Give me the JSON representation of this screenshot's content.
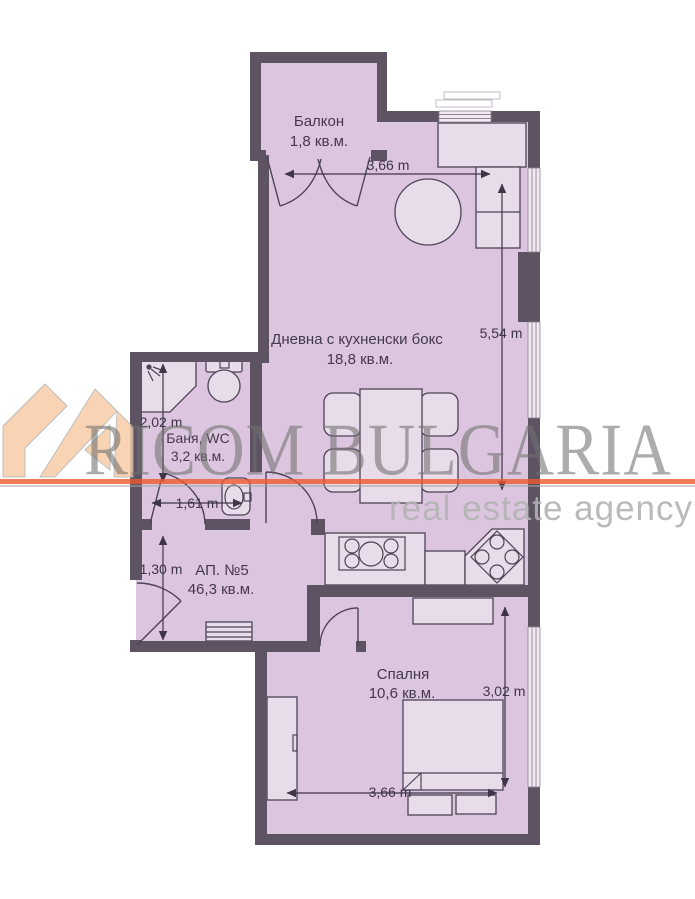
{
  "watermark": {
    "brand": "RICOM BULGARIA",
    "tagline": "real estate agency",
    "accent_color": "#ee5a2d",
    "logo_color": "#f8cda8",
    "brand_text_color": "#707070",
    "tagline_color": "#b2b2b2"
  },
  "plan": {
    "colors": {
      "wall": "#5d5362",
      "room_fill": "#dcc5de",
      "furniture_fill": "#e9dcea",
      "outline": "#4d4356",
      "window_fill": "#f2e9f3",
      "label_text": "#44394d",
      "dimension_text": "#3e3547"
    },
    "rooms": [
      {
        "name": "Балкон",
        "area": "1,8 кв.м."
      },
      {
        "name": "Дневна с кухненски бокс",
        "area": "18,8 кв.м."
      },
      {
        "name": "Баня, WC",
        "area": "3,2 кв.м."
      },
      {
        "name": "АП. №5",
        "area": "46,3 кв.м."
      },
      {
        "name": "Спалня",
        "area": "10,6 кв.м."
      }
    ],
    "dimensions": [
      {
        "label": "3,66 m",
        "location": "living-top"
      },
      {
        "label": "5,54 m",
        "location": "living-right"
      },
      {
        "label": "2,02 m",
        "location": "bathroom-left"
      },
      {
        "label": "1,61 m",
        "location": "bathroom-bottom"
      },
      {
        "label": "1,30 m",
        "location": "hallway-left"
      },
      {
        "label": "3,02 m",
        "location": "bedroom-right"
      },
      {
        "label": "3,66 m",
        "location": "bedroom-bottom"
      }
    ]
  }
}
